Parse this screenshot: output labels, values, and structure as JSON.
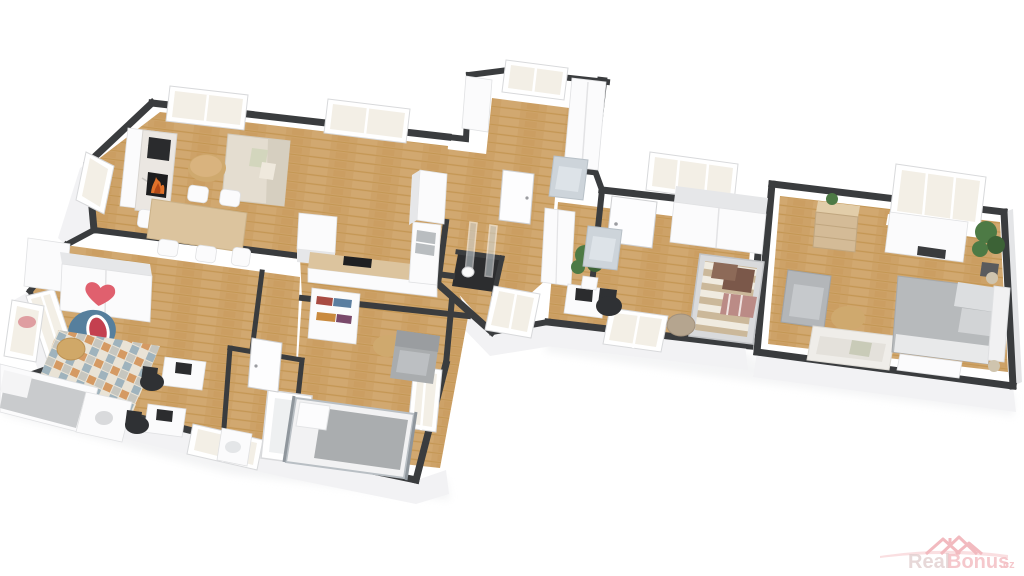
{
  "image_type": "3d-floorplan-render",
  "watermark": {
    "brand_prefix": "Real",
    "brand_suffix": "Bonus",
    "tld": ".cz"
  },
  "colors": {
    "background": "#ffffff",
    "wall_cap": "#3a3c3e",
    "wall_cap_dark": "#2c2d2f",
    "exterior_skirt": "#f2f2f4",
    "skirt_shade": "#e4e5e7",
    "floor_wood": "#cda268",
    "floor_wood_dark": "#c2954f",
    "floor_wood_light": "#d9b37e",
    "marble": "#ebe7e2",
    "marble_vein": "#c9c6c2",
    "fire_orange": "#e0722a",
    "fire_deep": "#b44a17",
    "sofa_cream": "#e4ddd0",
    "sofa_cream_shade": "#d6cfc0",
    "wood_furniture": "#cfa96e",
    "table_wood": "#dcc49e",
    "white_furniture": "#fbfbfc",
    "furniture_shade": "#e6e7e9",
    "gray_upholstery": "#b6b9bc",
    "gray_dark": "#9a9da0",
    "rug_base": "#e9e3d6",
    "rug_orange": "#d59a63",
    "rug_blue": "#9fb3bd",
    "rug_gray": "#c6c6bf",
    "shark_blue": "#567f9d",
    "shark_mouth": "#c4404f",
    "heart_red": "#e0606e",
    "plant_green": "#4d7a45",
    "plant_green_dark": "#3c6236",
    "daybed_stripe": "#cbb89a",
    "daybed_light": "#f0ebe0",
    "pillow_brown": "#7b584a",
    "pillow_stripe": "#bb8b86",
    "office_chair": "#2f3134",
    "glass": "#cfd8dc",
    "steel": "#b9bdc0",
    "watermark_pink": "#f0aeb4",
    "watermark_gray": "#dcc6c6",
    "watermark_light": "#f7cfd3"
  },
  "scene": {
    "view": "3d-perspective-top",
    "rooms": [
      {
        "name": "living-dining-kitchen",
        "furniture": [
          "fireplace",
          "tv",
          "sofa",
          "coffee-table",
          "dining-table",
          "chairs",
          "kitchen-island",
          "kitchen-counter",
          "cooktop",
          "sink",
          "fridge-column",
          "windows"
        ]
      },
      {
        "name": "kids-bedroom",
        "furniture": [
          "sliding-wardrobe-heart",
          "shark-chair",
          "diamond-rug",
          "stool",
          "single-bed",
          "two-desks",
          "office-chairs",
          "window"
        ]
      },
      {
        "name": "bathroom",
        "furniture": [
          "bathtub",
          "washbasin",
          "window"
        ]
      },
      {
        "name": "bedroom",
        "furniture": [
          "bookshelf",
          "side-table",
          "armchair",
          "metal-bed",
          "window"
        ]
      },
      {
        "name": "dressing-room",
        "furniture": [
          "wardrobes",
          "floral-armchair",
          "window"
        ]
      },
      {
        "name": "shower-room",
        "furniture": [
          "glass-shower",
          "toilet"
        ]
      },
      {
        "name": "study-guest-room",
        "furniture": [
          "desk",
          "monitor",
          "office-chair",
          "plant",
          "floral-armchair",
          "striped-daybed",
          "pouf",
          "wardrobe",
          "windows"
        ]
      },
      {
        "name": "master-bedroom",
        "furniture": [
          "double-bed",
          "nightlamps",
          "bench",
          "white-sofa",
          "armchair",
          "coffee-table",
          "dresser",
          "tv-console",
          "plants",
          "window"
        ]
      }
    ]
  }
}
